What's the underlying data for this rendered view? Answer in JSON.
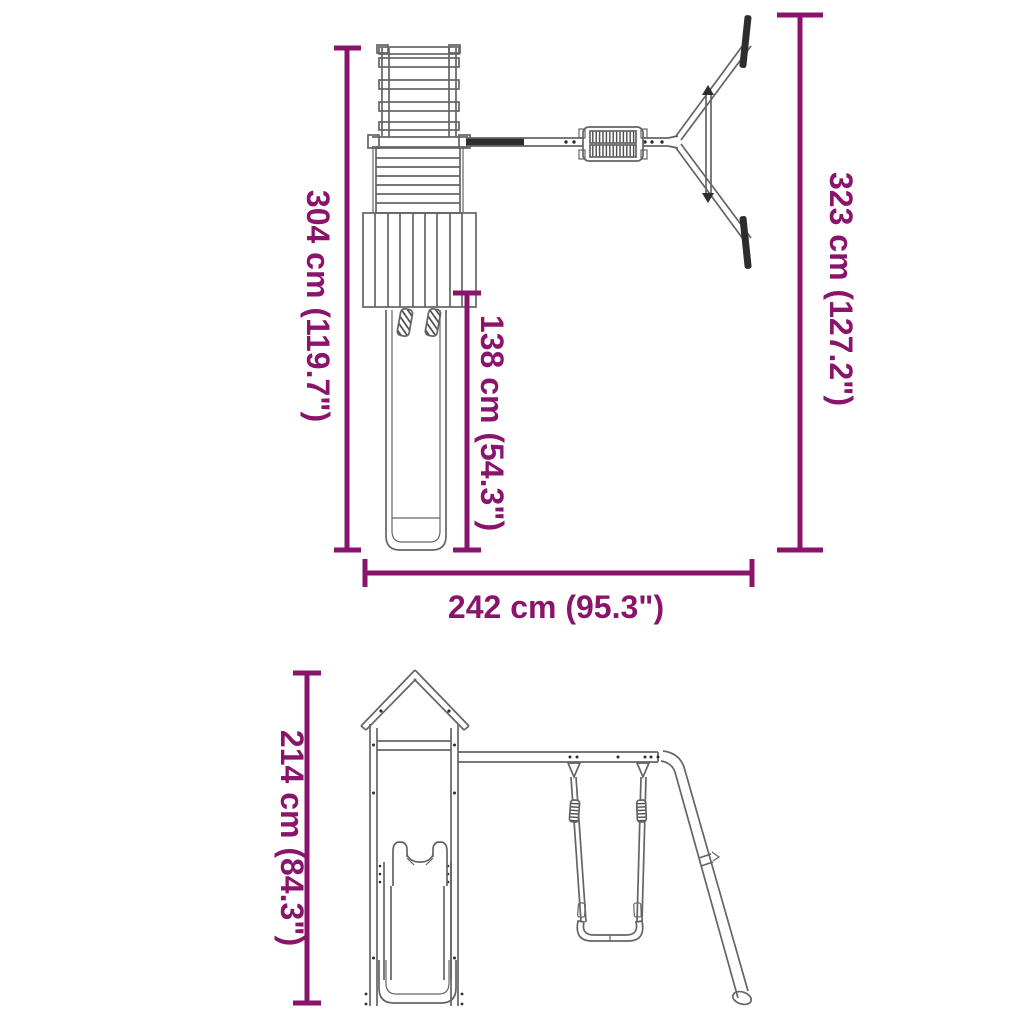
{
  "colors": {
    "dimension": "#8a146c",
    "line_art": "#646464",
    "line_art_dark": "#2d2d2d",
    "background": "#ffffff"
  },
  "dimensions": {
    "d304": {
      "label": "304 cm (119.7\")"
    },
    "d138": {
      "label": "138 cm (54.3\")"
    },
    "d323": {
      "label": "323 cm (127.2\")"
    },
    "d242": {
      "label": "242 cm (95.3\")"
    },
    "d214": {
      "label": "214 cm (84.3\")"
    }
  }
}
